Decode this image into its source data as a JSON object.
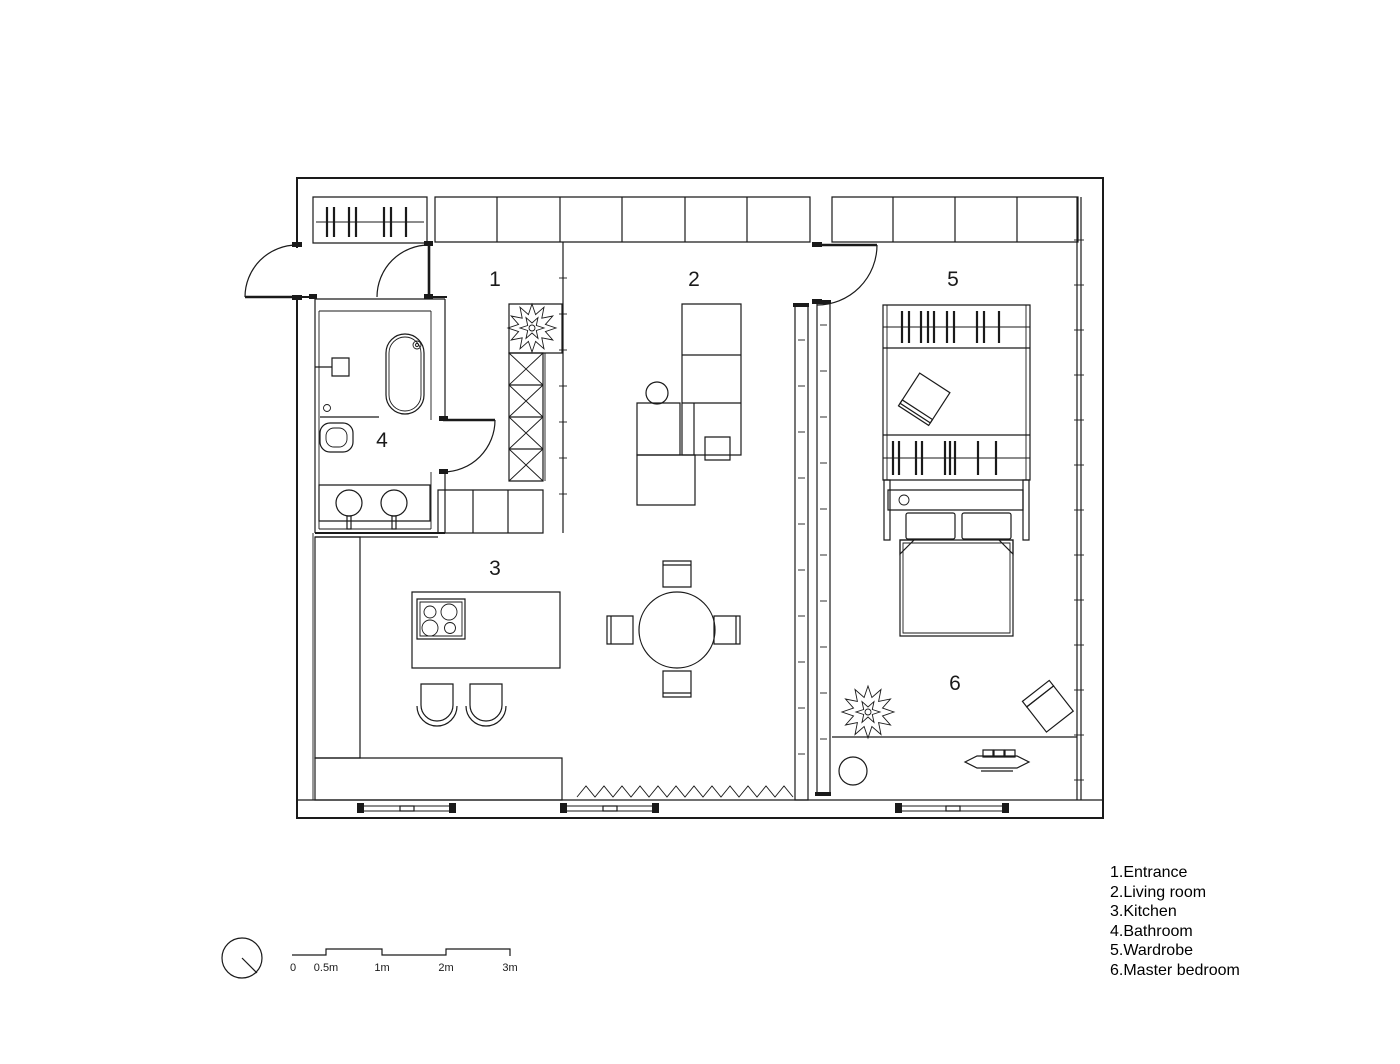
{
  "drawing": {
    "type": "apartment-floor-plan",
    "line_color": "#1a1a1a",
    "background": "#ffffff"
  },
  "rooms": [
    {
      "number": "1",
      "name": "Entrance"
    },
    {
      "number": "2",
      "name": "Living room"
    },
    {
      "number": "3",
      "name": "Kitchen"
    },
    {
      "number": "4",
      "name": "Bathroom"
    },
    {
      "number": "5",
      "name": "Wardrobe"
    },
    {
      "number": "6",
      "name": "Master bedroom"
    }
  ],
  "legend": {
    "items": [
      "1.Entrance",
      "2.Living room",
      "3.Kitchen",
      "4.Bathroom",
      "5.Wardrobe",
      "6.Master bedroom"
    ]
  },
  "scale_bar": {
    "labels": [
      "0",
      "0.5m",
      "1m",
      "2m",
      "3m"
    ]
  }
}
